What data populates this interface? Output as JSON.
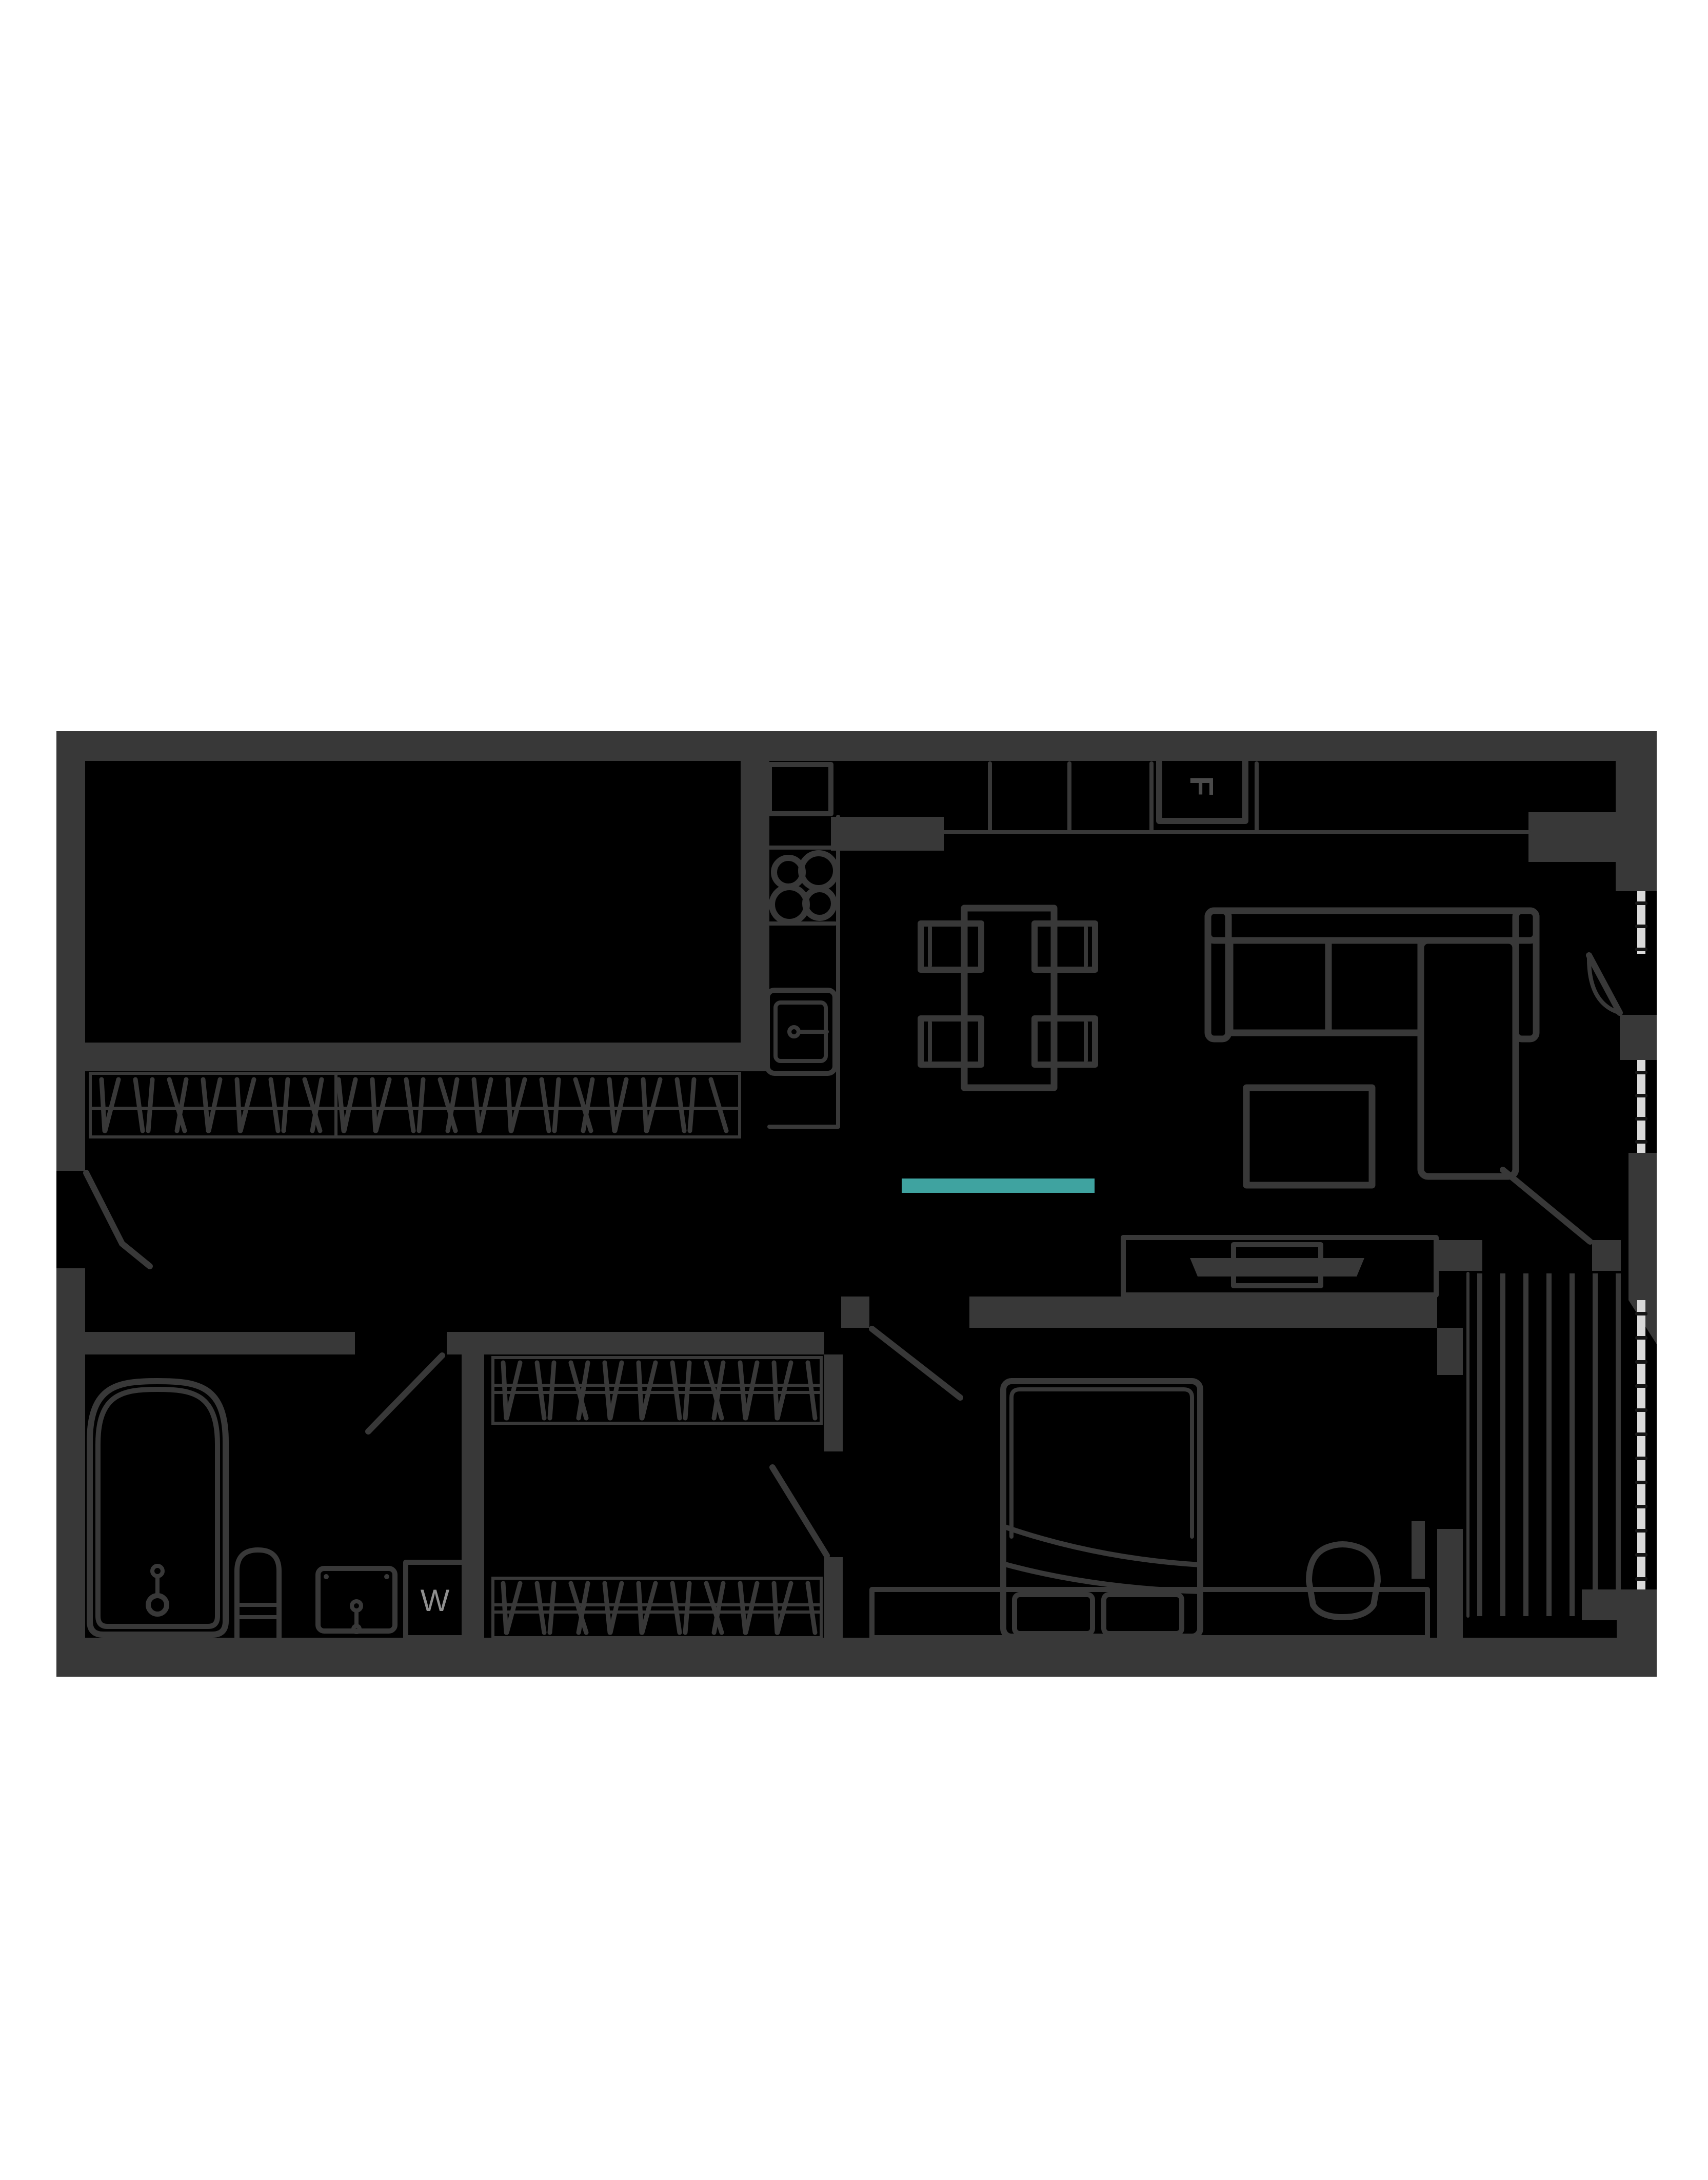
{
  "page": {
    "background": "#ffffff"
  },
  "floor_plan": {
    "colors": {
      "floor": "#000000",
      "wall": "#383838",
      "glazing": "#d9d9d9",
      "accent_teal": "#3fa3a0",
      "fridge_label_color": "#4a4a4a",
      "washer_label_color": "#8f8f8f"
    },
    "labels": {
      "fridge": "F",
      "washing_machine": "W"
    }
  }
}
